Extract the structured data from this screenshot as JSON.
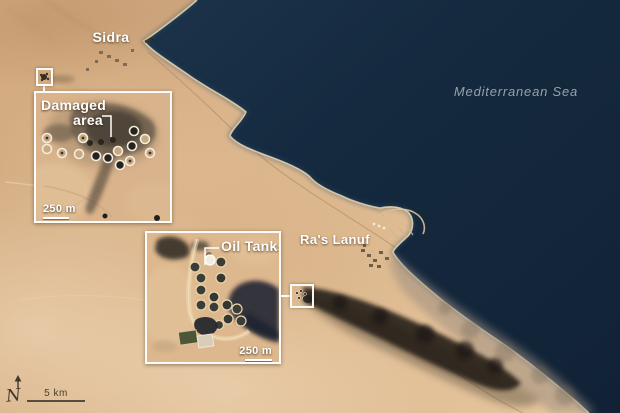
{
  "map": {
    "place_labels": {
      "sidra": "Sidra",
      "mediterranean_sea": "Mediterranean Sea",
      "ras_lanuf": "Ra's Lanuf"
    },
    "compass": {
      "label": "N"
    },
    "scale_bar": {
      "label": "5 km"
    },
    "colors": {
      "sea": "#142639",
      "sand": "#dcb78d",
      "smoke": "#241f18",
      "beach": "#f0dcb4",
      "label_white": "#ffffff",
      "sea_label_gray": "#95a2ad",
      "annotation_dark": "#3e392e"
    }
  },
  "insets": {
    "damaged_area": {
      "title_line1": "Damaged",
      "title_line2": "area",
      "scale_label": "250 m"
    },
    "oil_tanks": {
      "title": "Oil Tanks",
      "scale_label": "250 m"
    }
  }
}
